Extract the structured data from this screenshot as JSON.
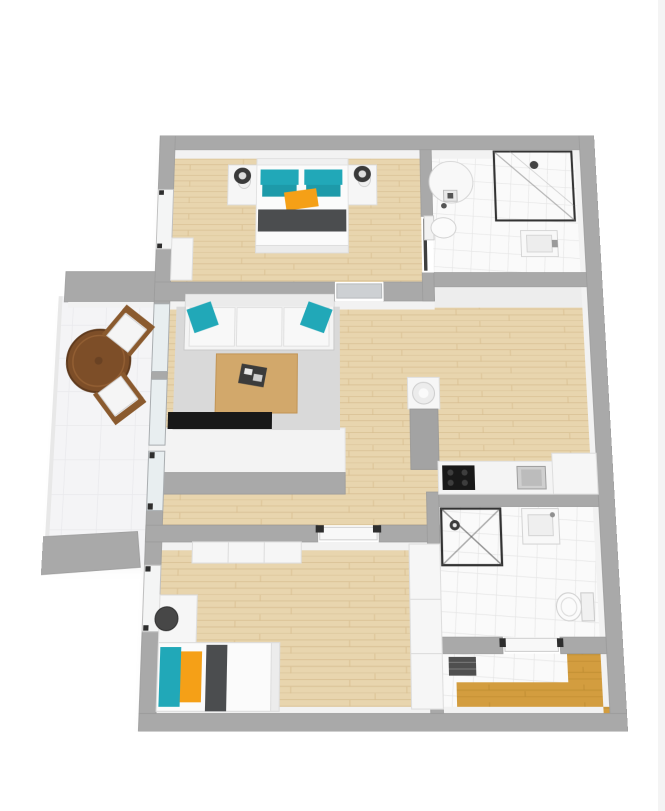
{
  "title": "3d-apartment-floor-plan",
  "colors": {
    "background": "#ffffff",
    "wall_gray": "#a9a9a9",
    "wall_edge": "#9c9c9c",
    "wall_face_white": "#f2f2f2",
    "wall_face_shaded": "#ededed",
    "wood_light": "#e8d5ae",
    "wood_grain": "#d8bf92",
    "wood_entry": "#d39d3f",
    "wood_entry_grain": "#bc8a2f",
    "tile_white": "#fafafa",
    "tile_grout": "#e4e4e4",
    "balcony_tile": "#f4f4f6",
    "balcony_grout": "#e9e9ec",
    "rug_gray": "#d9d9d9",
    "furn_white": "#f6f6f6",
    "fixture_white": "#f8f8f8",
    "teal": "#21a8b8",
    "teal_dark": "#1d9aa9",
    "orange": "#f5a017",
    "dark_gray": "#4b4d4f",
    "black": "#181818",
    "table_wood": "#d2a86b",
    "balcony_table_wood": "#7d4e28",
    "chair_wood": "#8a5a2e",
    "window_white": "#f4f5f5",
    "glass_blue": "#e8eef0",
    "door_leaf": "#cdd0d3",
    "hinge_dark": "#2e2e2e",
    "shower_frame": "#333333",
    "column_gray": "#a3a3a3"
  },
  "floorplan": {
    "view": "3d-top-down-perspective",
    "rooms": [
      {
        "name": "bedroom-1",
        "position": "top-left",
        "floor": "light-wood",
        "furniture": [
          "double-bed",
          "teal-pillows",
          "orange-pillow",
          "nightstand-left",
          "nightstand-right",
          "lamp-left",
          "lamp-right",
          "dresser"
        ]
      },
      {
        "name": "bathroom-1",
        "position": "top-right",
        "floor": "white-tile",
        "furniture": [
          "water-heater",
          "toilet",
          "corner-shower",
          "sink"
        ]
      },
      {
        "name": "living-room",
        "position": "middle-left",
        "floor": "light-wood",
        "furniture": [
          "white-sofa",
          "teal-cushions",
          "rug",
          "coffee-table",
          "tv"
        ]
      },
      {
        "name": "balcony",
        "position": "left",
        "floor": "white-tile",
        "furniture": [
          "round-wood-table",
          "chair",
          "chair"
        ]
      },
      {
        "name": "hall-kitchen",
        "position": "middle-right",
        "floor": "light-wood",
        "furniture": [
          "utility-column",
          "kitchen-counter",
          "cooktop",
          "kitchen-sink",
          "fridge"
        ]
      },
      {
        "name": "bedroom-2",
        "position": "bottom-left",
        "floor": "light-wood",
        "furniture": [
          "single-bed",
          "teal-pillow",
          "orange-pillow",
          "desk",
          "stool",
          "wardrobe-north",
          "wardrobe-east"
        ]
      },
      {
        "name": "bathroom-2",
        "position": "bottom-right",
        "floor": "white-tile",
        "furniture": [
          "shower",
          "sink",
          "toilet"
        ]
      },
      {
        "name": "entry-hall",
        "position": "bottom-right-corner",
        "floor": "tile-and-oak",
        "furniture": [
          "doormat"
        ]
      }
    ]
  }
}
